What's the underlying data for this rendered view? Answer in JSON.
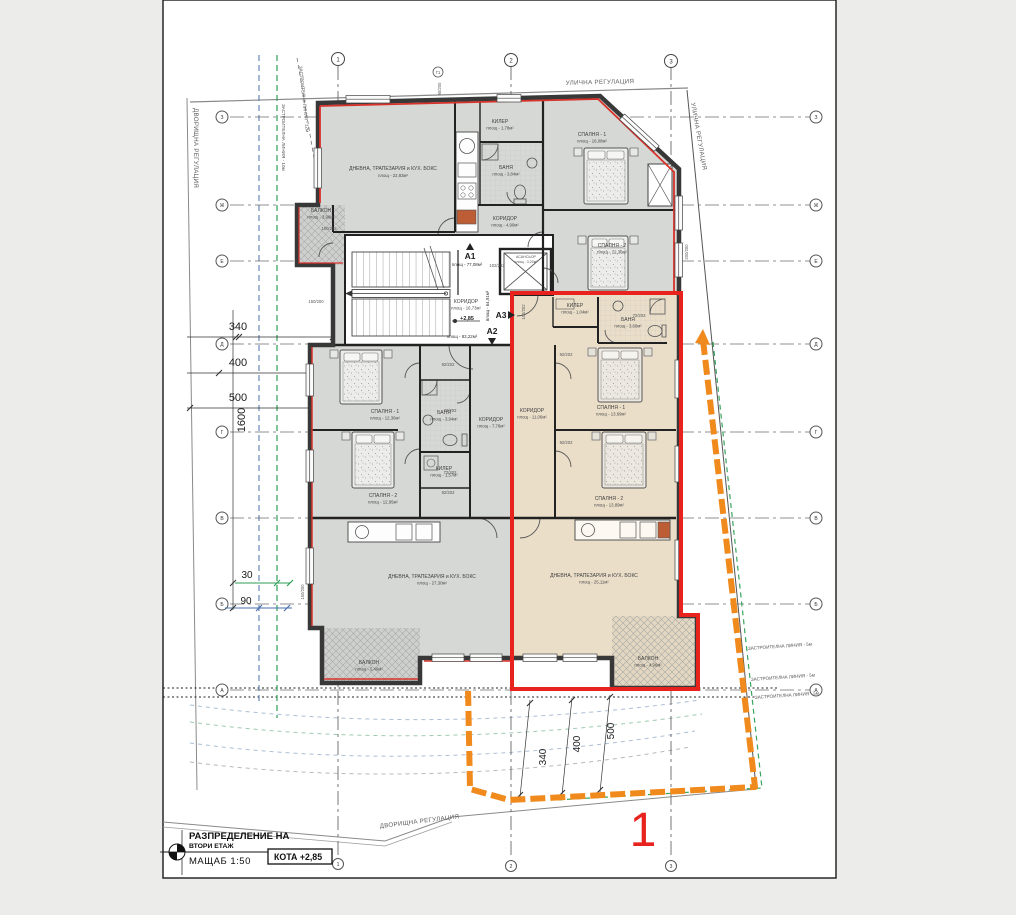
{
  "colors": {
    "paper": "#ffffff",
    "page_bg": "#ecedeb",
    "unit_gray": "#d6d8d5",
    "unit_beige": "#eadec9",
    "boundary_red": "#e8231d",
    "insulation_red": "#d8322a",
    "plot_orange": "#f08a1d",
    "reg_line_green": "#3aa45f",
    "dim_green": "#2e9e57",
    "dim_blue": "#4a6fae",
    "wall": "#383838"
  },
  "regulation": {
    "street": "УЛИЧНА РЕГУЛАЦИЯ",
    "street_side": "УЛИЧНА РЕГУЛАЦИЯ",
    "yard_left": "ДВОРИЩНА РЕГУЛАЦИЯ",
    "yard_bottom": "ДВОРИЩНА РЕГУЛАЦИЯ",
    "line10": "ЗАСТРОИТЕЛНА ЛИНИЯ - 10м",
    "line12": "ЗАСТРОИТЕЛНА ЛИНИЯ - 12м",
    "line5_a": "ЗАСТРОИТЕЛНА ЛИНИЯ - 5м",
    "line5_b": "ЗАСТРОИТЕЛНА ЛИНИЯ - 5м",
    "line5_c": "ЗАСТРОИТЕЛНА ЛИНИЯ - 5м"
  },
  "axes": {
    "cols": [
      "1",
      "2",
      "3"
    ],
    "rows": [
      "З",
      "Ж",
      "Е",
      "Д",
      "Г",
      "В",
      "Б",
      "А"
    ]
  },
  "dims": {
    "left": [
      "340",
      "400",
      "500",
      "1600"
    ],
    "offset_green": "30",
    "offset_blue": "90",
    "bottom": [
      "340",
      "400",
      "500"
    ]
  },
  "plot": {
    "number": "1"
  },
  "core": {
    "corridor_name": "КОРИДОР",
    "corridor_area": "площ - 16,73м²",
    "level": "+2,85",
    "elevator_name": "АСАНСЬОР",
    "elevator_area": "площ - 3,20м²"
  },
  "units": {
    "a1": {
      "tag": "А1",
      "area": "площ - 77,08м²"
    },
    "a2": {
      "tag": "А2",
      "area": "площ - 83,22м²"
    },
    "a3": {
      "tag": "А3",
      "area": "площ - 64,91м²"
    }
  },
  "rooms": {
    "a1_living": {
      "name": "ДНЕВНА, ТРАПЕЗАРИЯ и КУХ. БОКС",
      "area": "площ - 22,83м²"
    },
    "a1_killer": {
      "name": "КИЛЕР",
      "area": "площ - 1,78м²"
    },
    "a1_bath": {
      "name": "БАНЯ",
      "area": "площ - 3,84м²"
    },
    "a1_corridor": {
      "name": "КОРИДОР",
      "area": "площ - 4,90м²"
    },
    "a1_bed1": {
      "name": "СПАЛНЯ - 1",
      "area": "площ - 16,08м²"
    },
    "a1_bed2": {
      "name": "СПАЛНЯ - 2",
      "area": "площ - 12,36м²"
    },
    "a1_balcony": {
      "name": "БАЛКОН",
      "area": "площ - 3,96м²"
    },
    "a2_bed1": {
      "name": "СПАЛНЯ - 1",
      "area": "площ - 12,36м²"
    },
    "a2_bed2": {
      "name": "СПАЛНЯ - 2",
      "area": "площ - 12,95м²"
    },
    "a2_bath": {
      "name": "БАНЯ",
      "area": "площ - 3,94м²"
    },
    "a2_killer": {
      "name": "КИЛЕР",
      "area": "площ - 1,57м²"
    },
    "a2_corridor": {
      "name": "КОРИДОР",
      "area": "площ - 7,78м²"
    },
    "a2_living": {
      "name": "ДНЕВНА, ТРАПЕЗАРИЯ и КУХ. БОКС",
      "area": "площ - 27,30м²"
    },
    "a2_balcony": {
      "name": "БАЛКОН",
      "area": "площ - 5,49м²"
    },
    "a3_killer": {
      "name": "КИЛЕР",
      "area": "площ - 1,04м²"
    },
    "a3_bath": {
      "name": "БАНЯ",
      "area": "площ - 3,60м²"
    },
    "a3_corridor": {
      "name": "КОРИДОР",
      "area": "площ - 11,06м²"
    },
    "a3_bed1": {
      "name": "СПАЛНЯ - 1",
      "area": "площ - 13,69м²"
    },
    "a3_bed2": {
      "name": "СПАЛНЯ - 2",
      "area": "площ - 13,89м²"
    },
    "a3_living": {
      "name": "ДНЕВНА, ТРАПЕЗАРИЯ и КУХ. БОКС",
      "area": "площ - 25,11м²"
    },
    "a3_balcony": {
      "name": "БАЛКОН",
      "area": "площ - 4,96м²"
    }
  },
  "tags": [
    "102/202",
    "92/202",
    "92/202",
    "72/202",
    "92/202",
    "72/202",
    "72/202",
    "92/202",
    "102/202",
    "150/200",
    "200/200",
    "90/200",
    "150/200",
    "100/205",
    "Г1"
  ],
  "titleblock": {
    "line1": "РАЗПРЕДЕЛЕНИЕ НА",
    "line2": "ВТОРИ ЕТАЖ",
    "scale": "МАЩАБ 1:50",
    "kota": "КОТА +2,85"
  }
}
